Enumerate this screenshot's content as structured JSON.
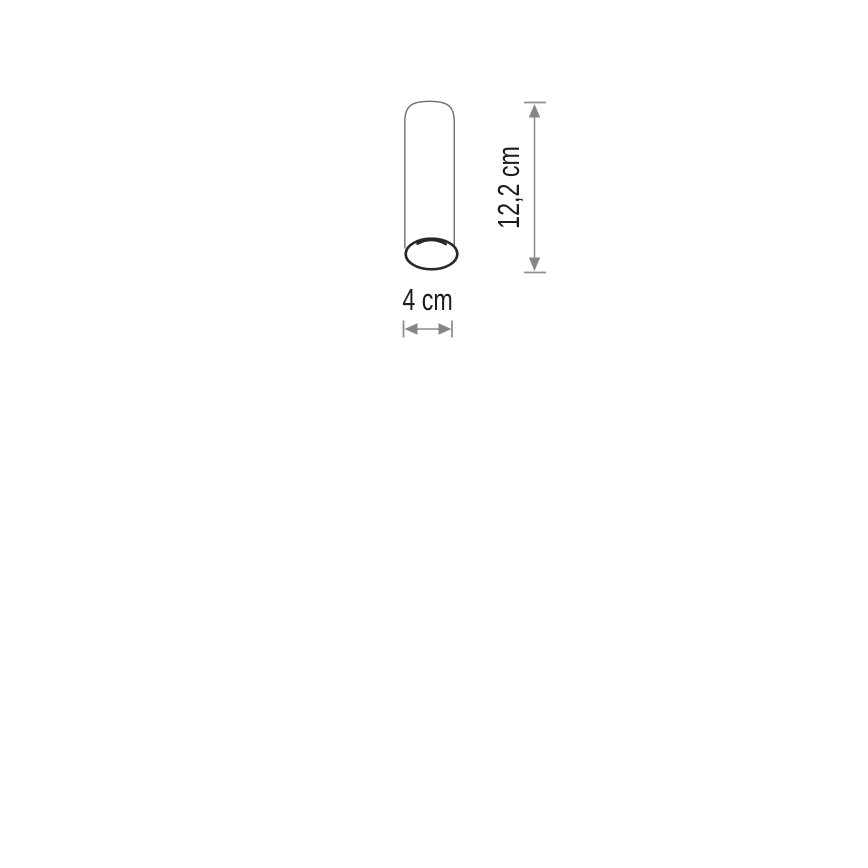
{
  "page": {
    "background": "#ffffff"
  },
  "figure": {
    "name": "cylinder-dimension-diagram",
    "subject": "cylindrical tube luminaire, line drawing with open bottom end",
    "height_dimension": {
      "label": "12,2 cm",
      "orientation": "vertical"
    },
    "width_dimension": {
      "label": "4 cm",
      "orientation": "horizontal"
    },
    "colors": {
      "outline": "#6e6e6e",
      "rim": "#282828",
      "rim_fill": "#ffffff",
      "dimension_line": "#8a8a8a",
      "dimension_cap": "#8f8f8f",
      "arrow": "#868686",
      "label_text": "#1c1c1c"
    }
  }
}
